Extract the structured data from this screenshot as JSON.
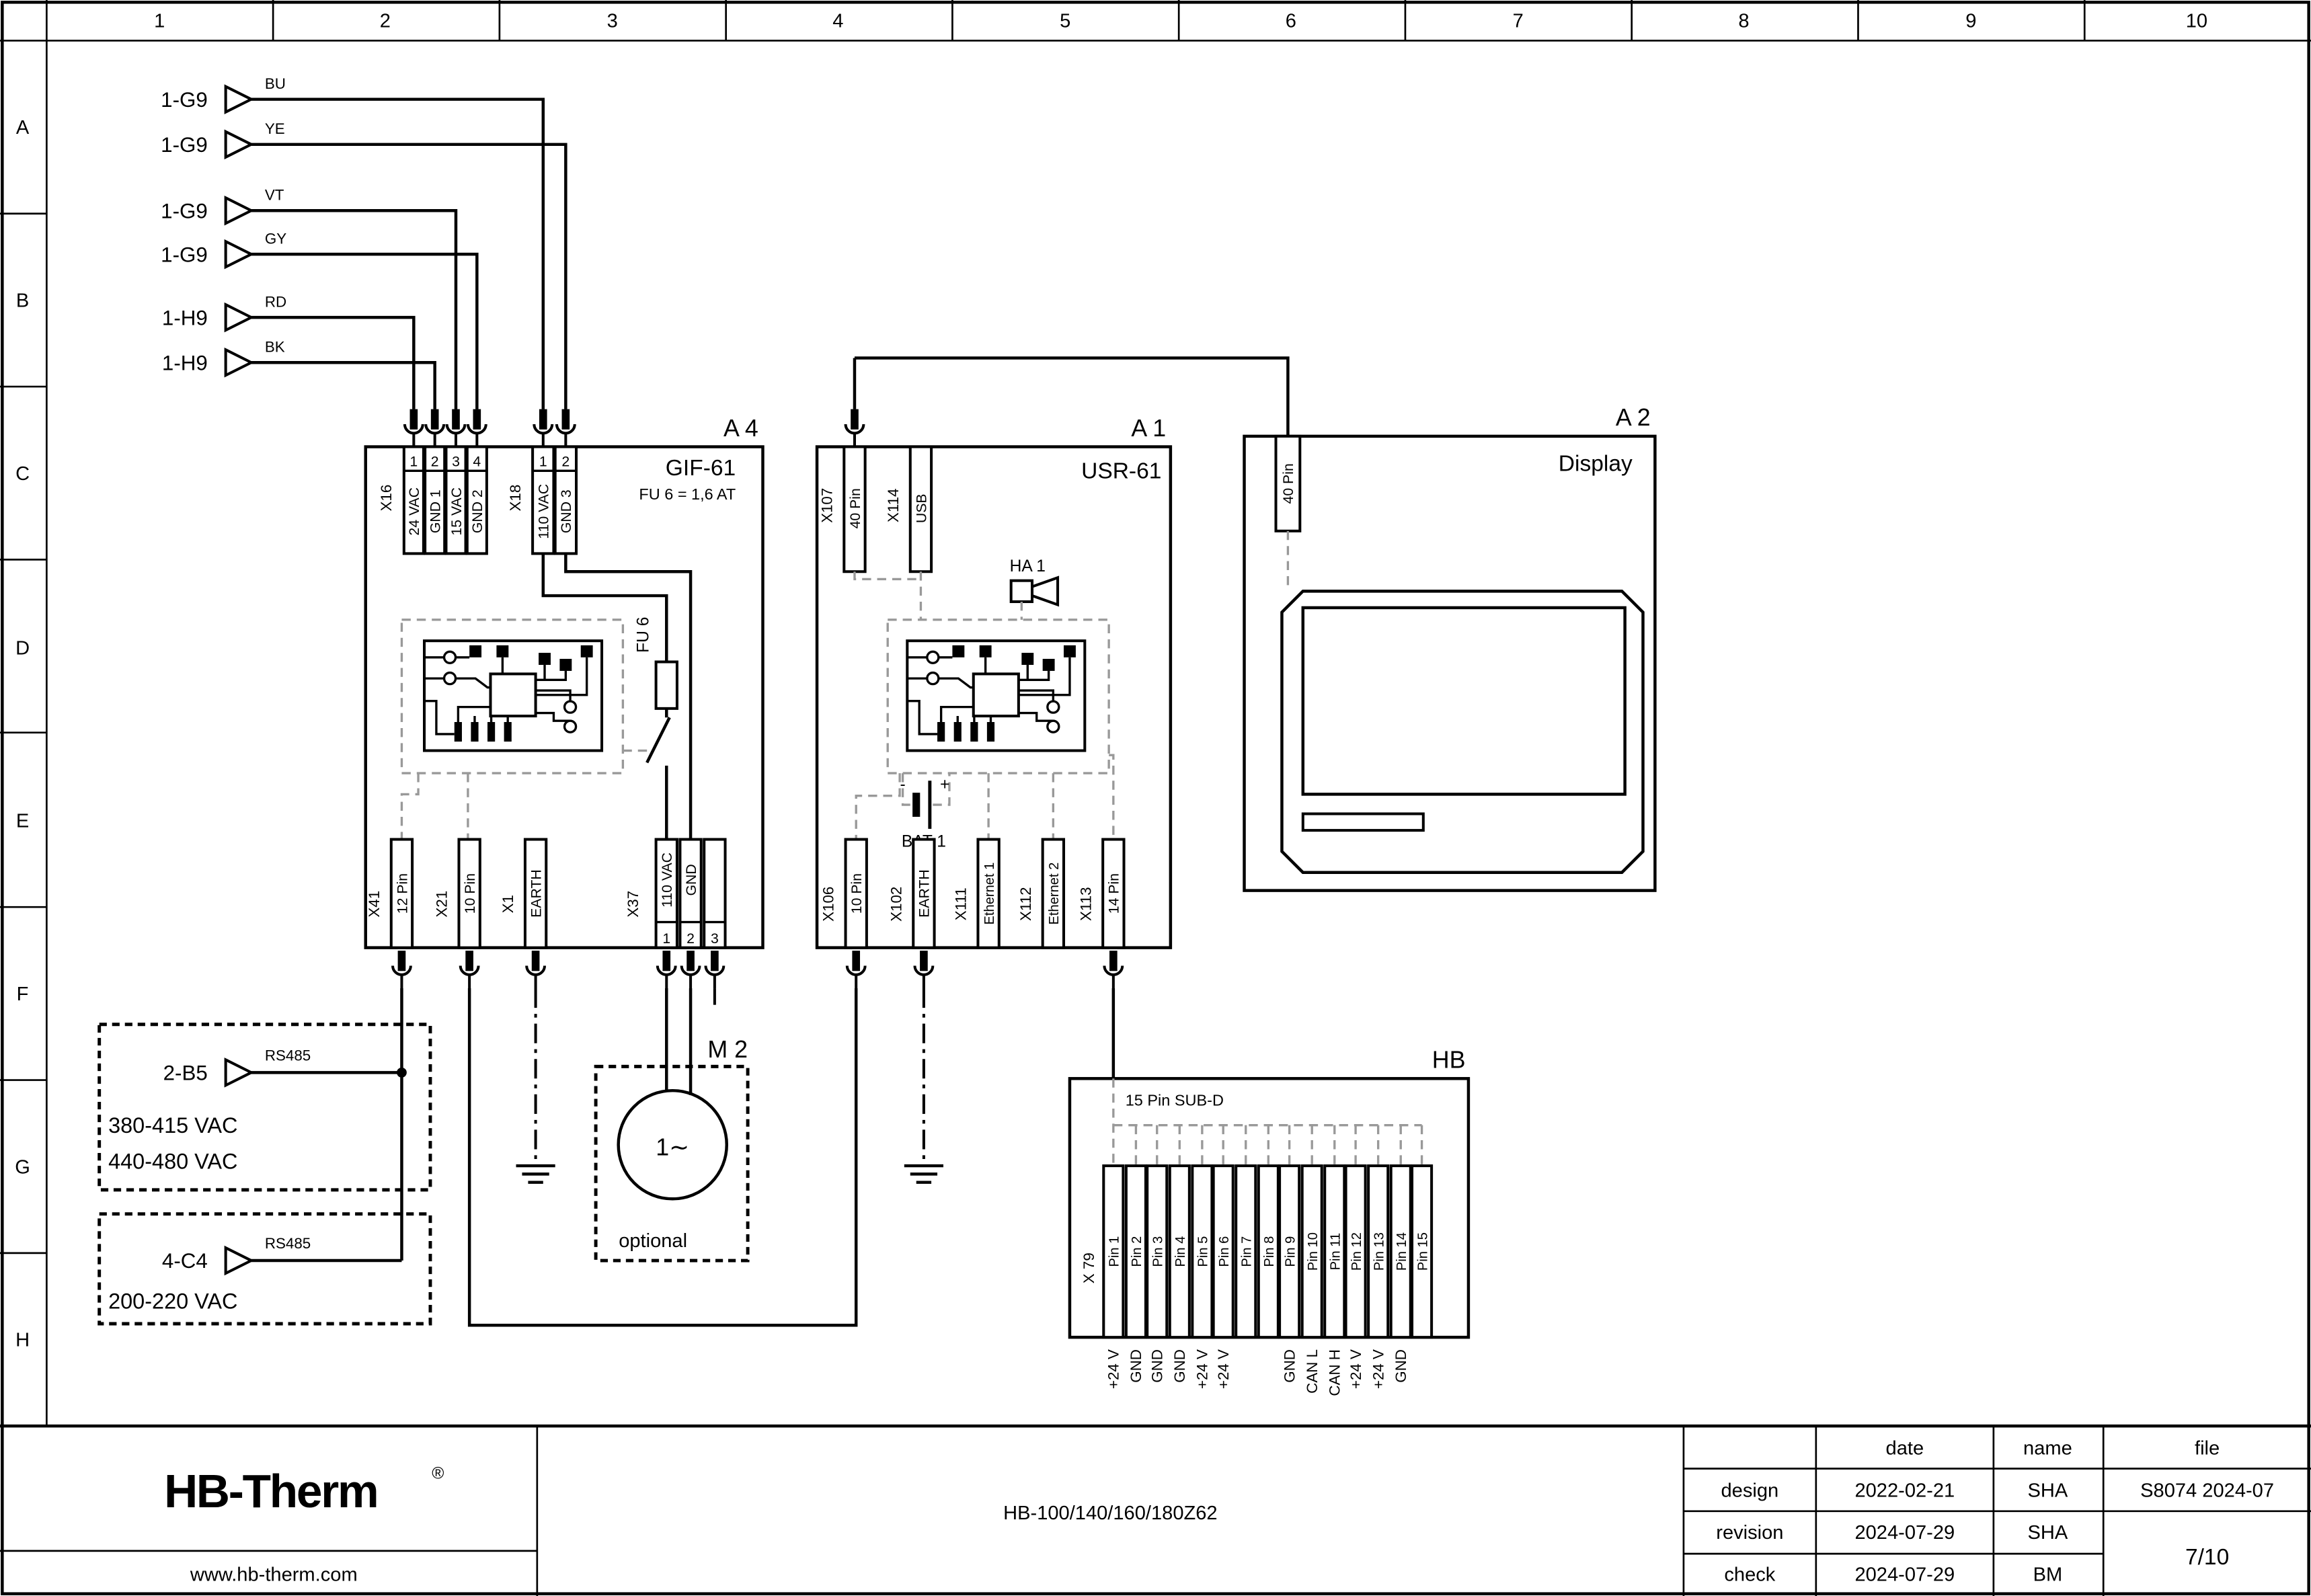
{
  "colors": {
    "ink": "#000000",
    "dashed_gray": "#999999",
    "logo_navy": "#1c2442"
  },
  "rulers": {
    "columns": [
      "1",
      "2",
      "3",
      "4",
      "5",
      "6",
      "7",
      "8",
      "9",
      "10"
    ],
    "rows": [
      "A",
      "B",
      "C",
      "D",
      "E",
      "F",
      "G",
      "H"
    ]
  },
  "inputs": [
    {
      "ref": "1-G9",
      "wire": "BU"
    },
    {
      "ref": "1-G9",
      "wire": "YE"
    },
    {
      "ref": "1-G9",
      "wire": "VT"
    },
    {
      "ref": "1-G9",
      "wire": "GY"
    },
    {
      "ref": "1-H9",
      "wire": "RD"
    },
    {
      "ref": "1-H9",
      "wire": "BK"
    }
  ],
  "a4": {
    "tag": "A 4",
    "device": "GIF-61",
    "fuse_note": "FU 6 = 1,6 AT",
    "fuse_label": "FU 6",
    "x16": {
      "id": "X16",
      "pins": [
        "1",
        "2",
        "3",
        "4"
      ],
      "labels": [
        "24 VAC",
        "GND 1",
        "15 VAC",
        "GND 2"
      ]
    },
    "x18": {
      "id": "X18",
      "pins": [
        "1",
        "2"
      ],
      "labels": [
        "110 VAC",
        "GND 3"
      ]
    },
    "x41": {
      "id": "X41",
      "label": "12 Pin"
    },
    "x21": {
      "id": "X21",
      "label": "10 Pin"
    },
    "x1": {
      "id": "X1",
      "label": "EARTH"
    },
    "x37": {
      "id": "X37",
      "pins": [
        "1",
        "2",
        "3"
      ],
      "labels": [
        "110 VAC",
        "GND",
        ""
      ]
    }
  },
  "a1": {
    "tag": "A 1",
    "device": "USR-61",
    "x107": {
      "id": "X107",
      "label": "40 Pin"
    },
    "x114": {
      "id": "X114",
      "label": "USB"
    },
    "horn_id": "HA 1",
    "battery": {
      "id": "BAT 1",
      "minus": "-",
      "plus": "+"
    },
    "x106": {
      "id": "X106",
      "label": "10 Pin"
    },
    "x102": {
      "id": "X102",
      "label": "EARTH"
    },
    "x111": {
      "id": "X111",
      "label": "Ethernet 1"
    },
    "x112": {
      "id": "X112",
      "label": "Ethernet 2"
    },
    "x113": {
      "id": "X113",
      "label": "14 Pin"
    }
  },
  "a2": {
    "tag": "A 2",
    "device": "Display",
    "conn_label": "40 Pin"
  },
  "m2": {
    "tag": "M 2",
    "symbol": "1∼",
    "note": "optional"
  },
  "hb": {
    "tag": "HB",
    "conn_title": "15 Pin SUB-D",
    "id": "X 79",
    "pins": [
      "Pin 1",
      "Pin 2",
      "Pin 3",
      "Pin 4",
      "Pin 5",
      "Pin 6",
      "Pin 7",
      "Pin 8",
      "Pin 9",
      "Pin 10",
      "Pin 11",
      "Pin 12",
      "Pin 13",
      "Pin 14",
      "Pin 15"
    ],
    "signals": [
      "+24 V",
      "GND",
      "GND",
      "GND",
      "+24 V",
      "+24 V",
      "",
      "",
      "GND",
      "CAN L",
      "CAN H",
      "+24 V",
      "+24 V",
      "GND",
      ""
    ]
  },
  "sources": [
    {
      "ref": "2-B5",
      "bus": "RS485",
      "voltages": [
        "380-415 VAC",
        "440-480 VAC"
      ]
    },
    {
      "ref": "4-C4",
      "bus": "RS485",
      "voltages": [
        "200-220 VAC"
      ]
    }
  ],
  "title_block": {
    "logo": "HB-Therm",
    "logo_reg": "®",
    "website": "www.hb-therm.com",
    "drawing_title": "HB-100/140/160/180Z62",
    "headers": {
      "date": "date",
      "name": "name",
      "file": "file"
    },
    "rows": [
      {
        "label": "design",
        "date": "2022-02-21",
        "name": "SHA"
      },
      {
        "label": "revision",
        "date": "2024-07-29",
        "name": "SHA"
      },
      {
        "label": "check",
        "date": "2024-07-29",
        "name": "BM"
      }
    ],
    "file_value": "S8074 2024-07",
    "sheet": "7/10"
  }
}
